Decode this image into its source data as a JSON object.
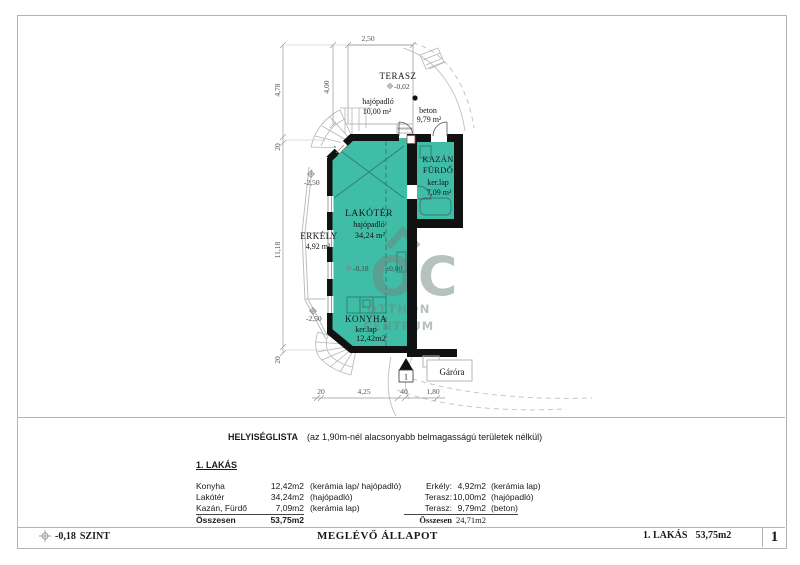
{
  "colors": {
    "room_fill": "#3FBDA6",
    "wall": "#111111",
    "thin_line": "#b5b5b5",
    "watermark": "#6e8680",
    "door_marker_red": "#c03a33"
  },
  "plan": {
    "terasz": {
      "name": "TERASZ",
      "level": "-0,02",
      "floor": "hajópadló",
      "area": "10,00 m²"
    },
    "beton": {
      "floor": "beton",
      "area": "9,79 m²"
    },
    "kazan": {
      "name1": "KAZÁN",
      "name2": "FÜRDŐ",
      "floor": "ker.lap",
      "area": "7,09 m²"
    },
    "lakoter": {
      "name": "LAKÓTÉR",
      "floor": "hajópadló",
      "area": "34,24 m²",
      "level": "-0,18"
    },
    "entry_level": "±0,00",
    "erkely": {
      "name": "ERKÉLY",
      "area": "4,92 m²",
      "level_top": "-2,50",
      "level_bottom": "-2,50"
    },
    "konyha": {
      "name": "KONYHA",
      "floor": "ker.lap",
      "area": "12,42m2"
    },
    "gazmeter": "Gáróra",
    "entry_number": "1",
    "dims": {
      "top": "2,50",
      "terasz_h": "4,00",
      "left_top": "4,78",
      "left_wall_top": "20",
      "left_main": "11,18",
      "left_wall_bottom": "20",
      "bottom_1": "20",
      "bottom_2": "4,25",
      "bottom_3": "40",
      "bottom_4": "1,80"
    },
    "watermark": {
      "letters": "OC",
      "line1": "OTTHON",
      "line2": "CENTRUM"
    }
  },
  "room_list": {
    "title": "HELYISÉGLISTA",
    "subtitle": "(az 1,90m-nél alacsonyabb belmagasságú területek nélkül)",
    "apartment_heading": "1. LAKÁS",
    "left_rows": [
      {
        "name": "Konyha",
        "area": "12,42m2",
        "finish": "(kerámia lap/ hajópadló)"
      },
      {
        "name": "Lakótér",
        "area": "34,24m2",
        "finish": "(hajópadló)"
      },
      {
        "name": "Kazán, Fürdő",
        "area": "7,09m2",
        "finish": "(kerámia lap)"
      }
    ],
    "left_total": {
      "label": "Összesen",
      "area": "53,75m2"
    },
    "right_rows": [
      {
        "name": "Erkély:",
        "area": "4,92m2",
        "finish": "(kerámia lap)"
      },
      {
        "name": "Terasz:",
        "area": "10,00m2",
        "finish": "(hajópadló)"
      },
      {
        "name": "Terasz:",
        "area": "9,79m2",
        "finish": "(beton)"
      }
    ],
    "right_total": {
      "label": "Összesen",
      "area": "24,71m2"
    }
  },
  "footer": {
    "level": "-0,18",
    "level_label": "SZINT",
    "status": "MEGLÉVŐ ÁLLAPOT",
    "apartment": "1. LAKÁS",
    "apartment_area": "53,75m2",
    "page": "1"
  }
}
